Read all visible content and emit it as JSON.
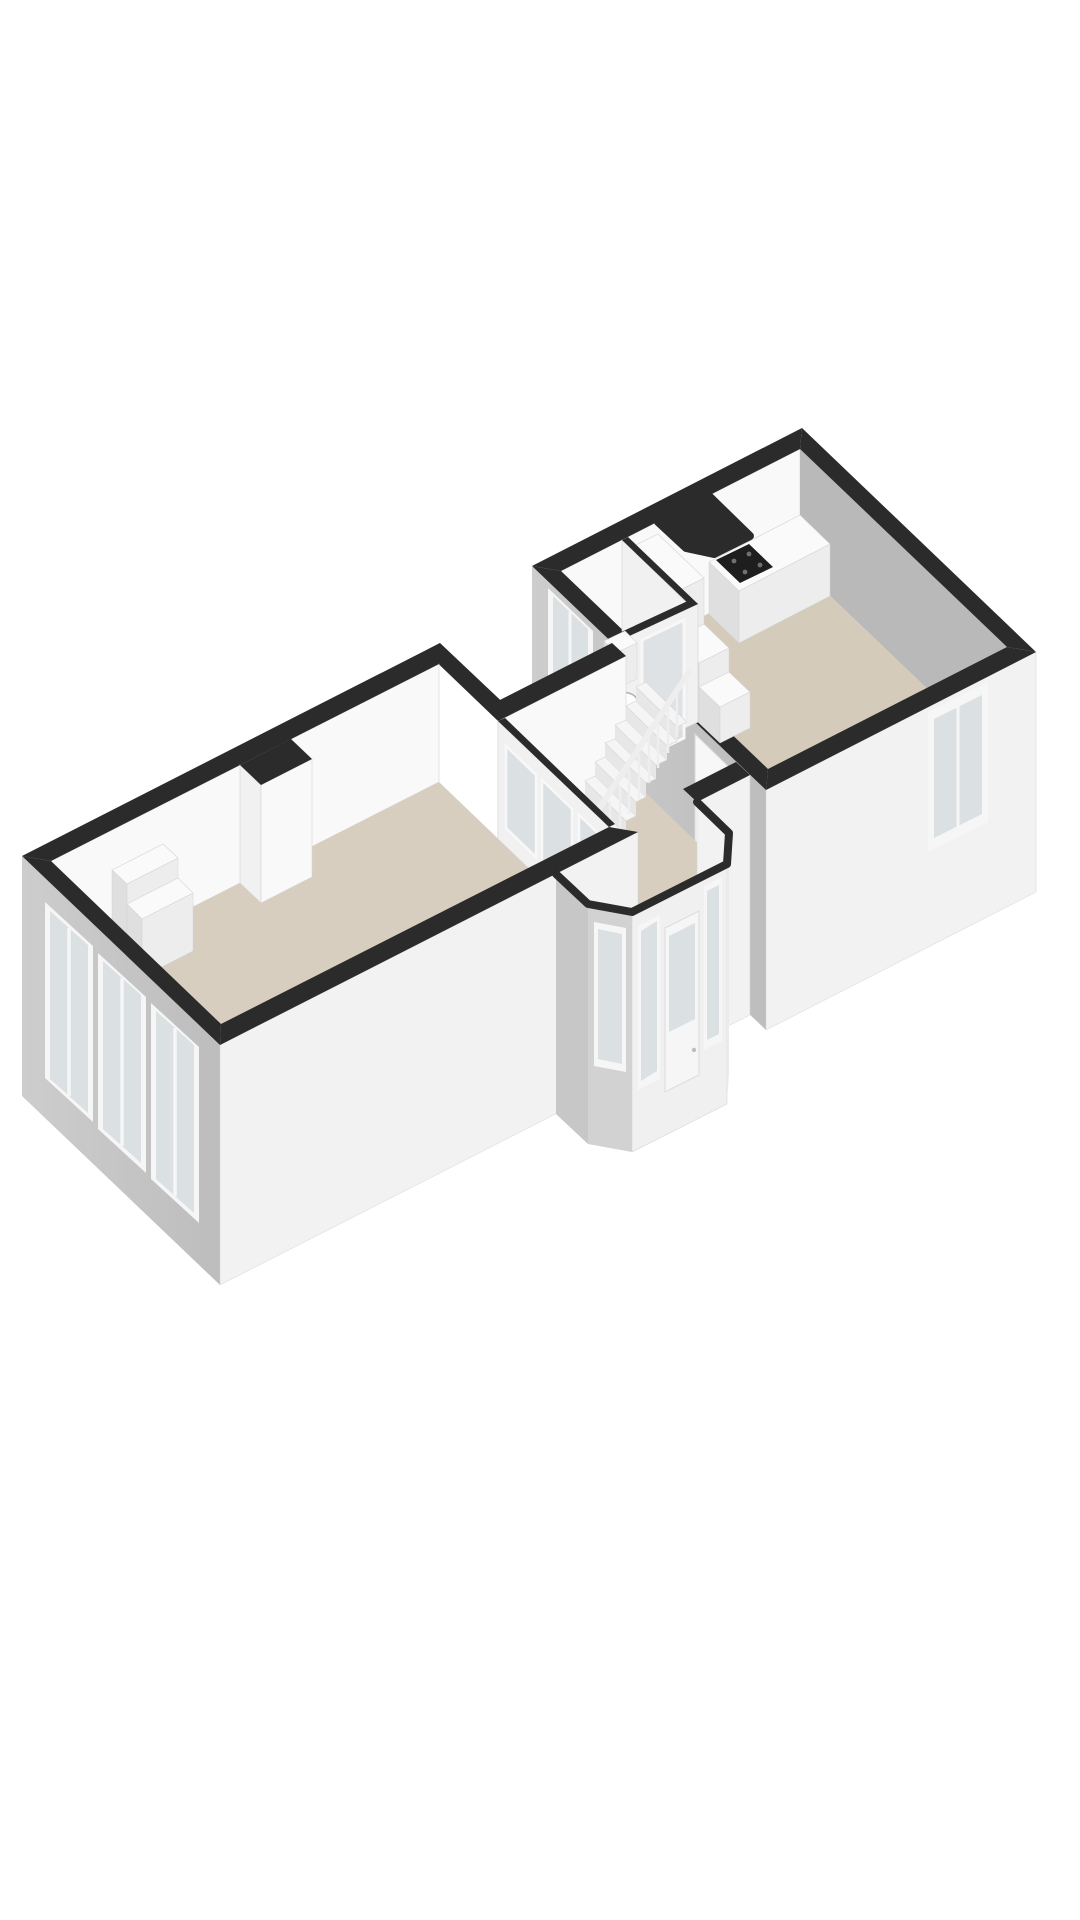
{
  "scene": {
    "type": "3d-floorplan-render",
    "description": "isometric 3D floor plan of an apartment floor, no text labels",
    "sections": [
      {
        "name": "living-room",
        "features": [
          "three facade windows",
          "chimney-breast",
          "two-tier cabinet block",
          "small wall steps",
          "glazed partition to vestibule"
        ]
      },
      {
        "name": "hall",
        "features": [
          "staircase with balustrade",
          "door to kitchen"
        ]
      },
      {
        "name": "entrance-vestibule",
        "features": [
          "angled bay",
          "glazed entrance door",
          "side windows"
        ]
      },
      {
        "name": "kitchen",
        "features": [
          "counter with gas cooktop",
          "duct shaft",
          "stepped stair bulkhead",
          "toilet room with glass sliding door",
          "side window",
          "rear window"
        ]
      }
    ]
  },
  "palette": {
    "bg": "#ffffff",
    "cap": "#2b2b2b",
    "floor": "#d7cebf",
    "floor2": "#d4cbba",
    "wall-lit": "#f9f9f9",
    "wall-mid": "#f1f1f1",
    "ext-gray": "#c7c7c7",
    "int-gray": "#b9b9b9",
    "ext-white": "#f2f2f2",
    "furn-top": "#fafafa",
    "furn-front": "#ededed",
    "furn-side": "#dfdfdf",
    "glass": "#dbe0e3",
    "frame": "#f6f6f6",
    "stair-top": "#f5f5f5",
    "stair-riser": "#e7e7e7",
    "stair-rail": "#eeeeee",
    "cooktop": "#1e1e1e",
    "burner": "#6f6f6f",
    "edge": "#d4d4d4",
    "shaft-deep": "#8f8f8f",
    "shaft-lit": "#c8c8c8",
    "fixture-stroke": "#aeb4b6"
  }
}
